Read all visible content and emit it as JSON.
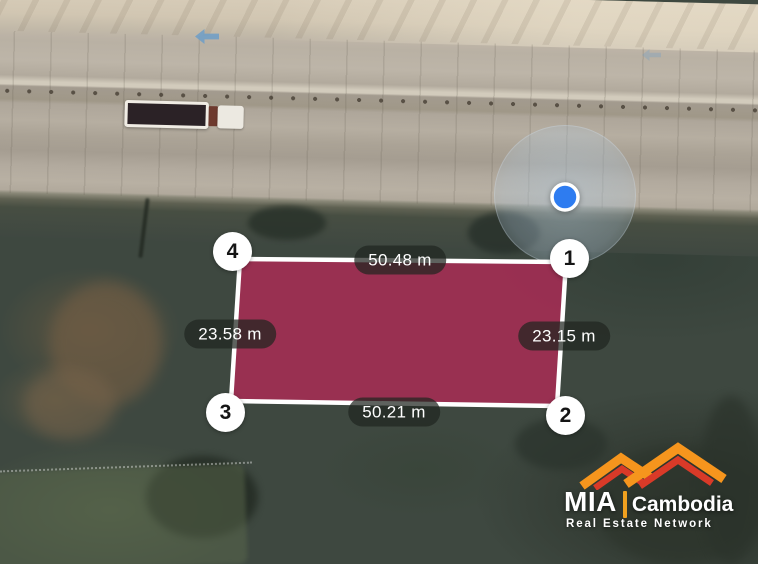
{
  "parcel": {
    "fill_color": "#ad2b56",
    "stroke_color": "#ffffff",
    "corner_markers": {
      "top_left": "4",
      "top_right": "1",
      "bottom_right": "2",
      "bottom_left": "3"
    },
    "measurements": {
      "top": "50.48 m",
      "right": "23.15 m",
      "bottom": "50.21 m",
      "left": "23.58 m"
    }
  },
  "gps": {
    "dot_color": "#2e7cf0"
  },
  "watermark": {
    "brand": "MIA",
    "separator": "|",
    "region": "Cambodia",
    "tagline": "Real Estate Network",
    "roof_orange": "#f6951d",
    "roof_red": "#d93a28"
  }
}
